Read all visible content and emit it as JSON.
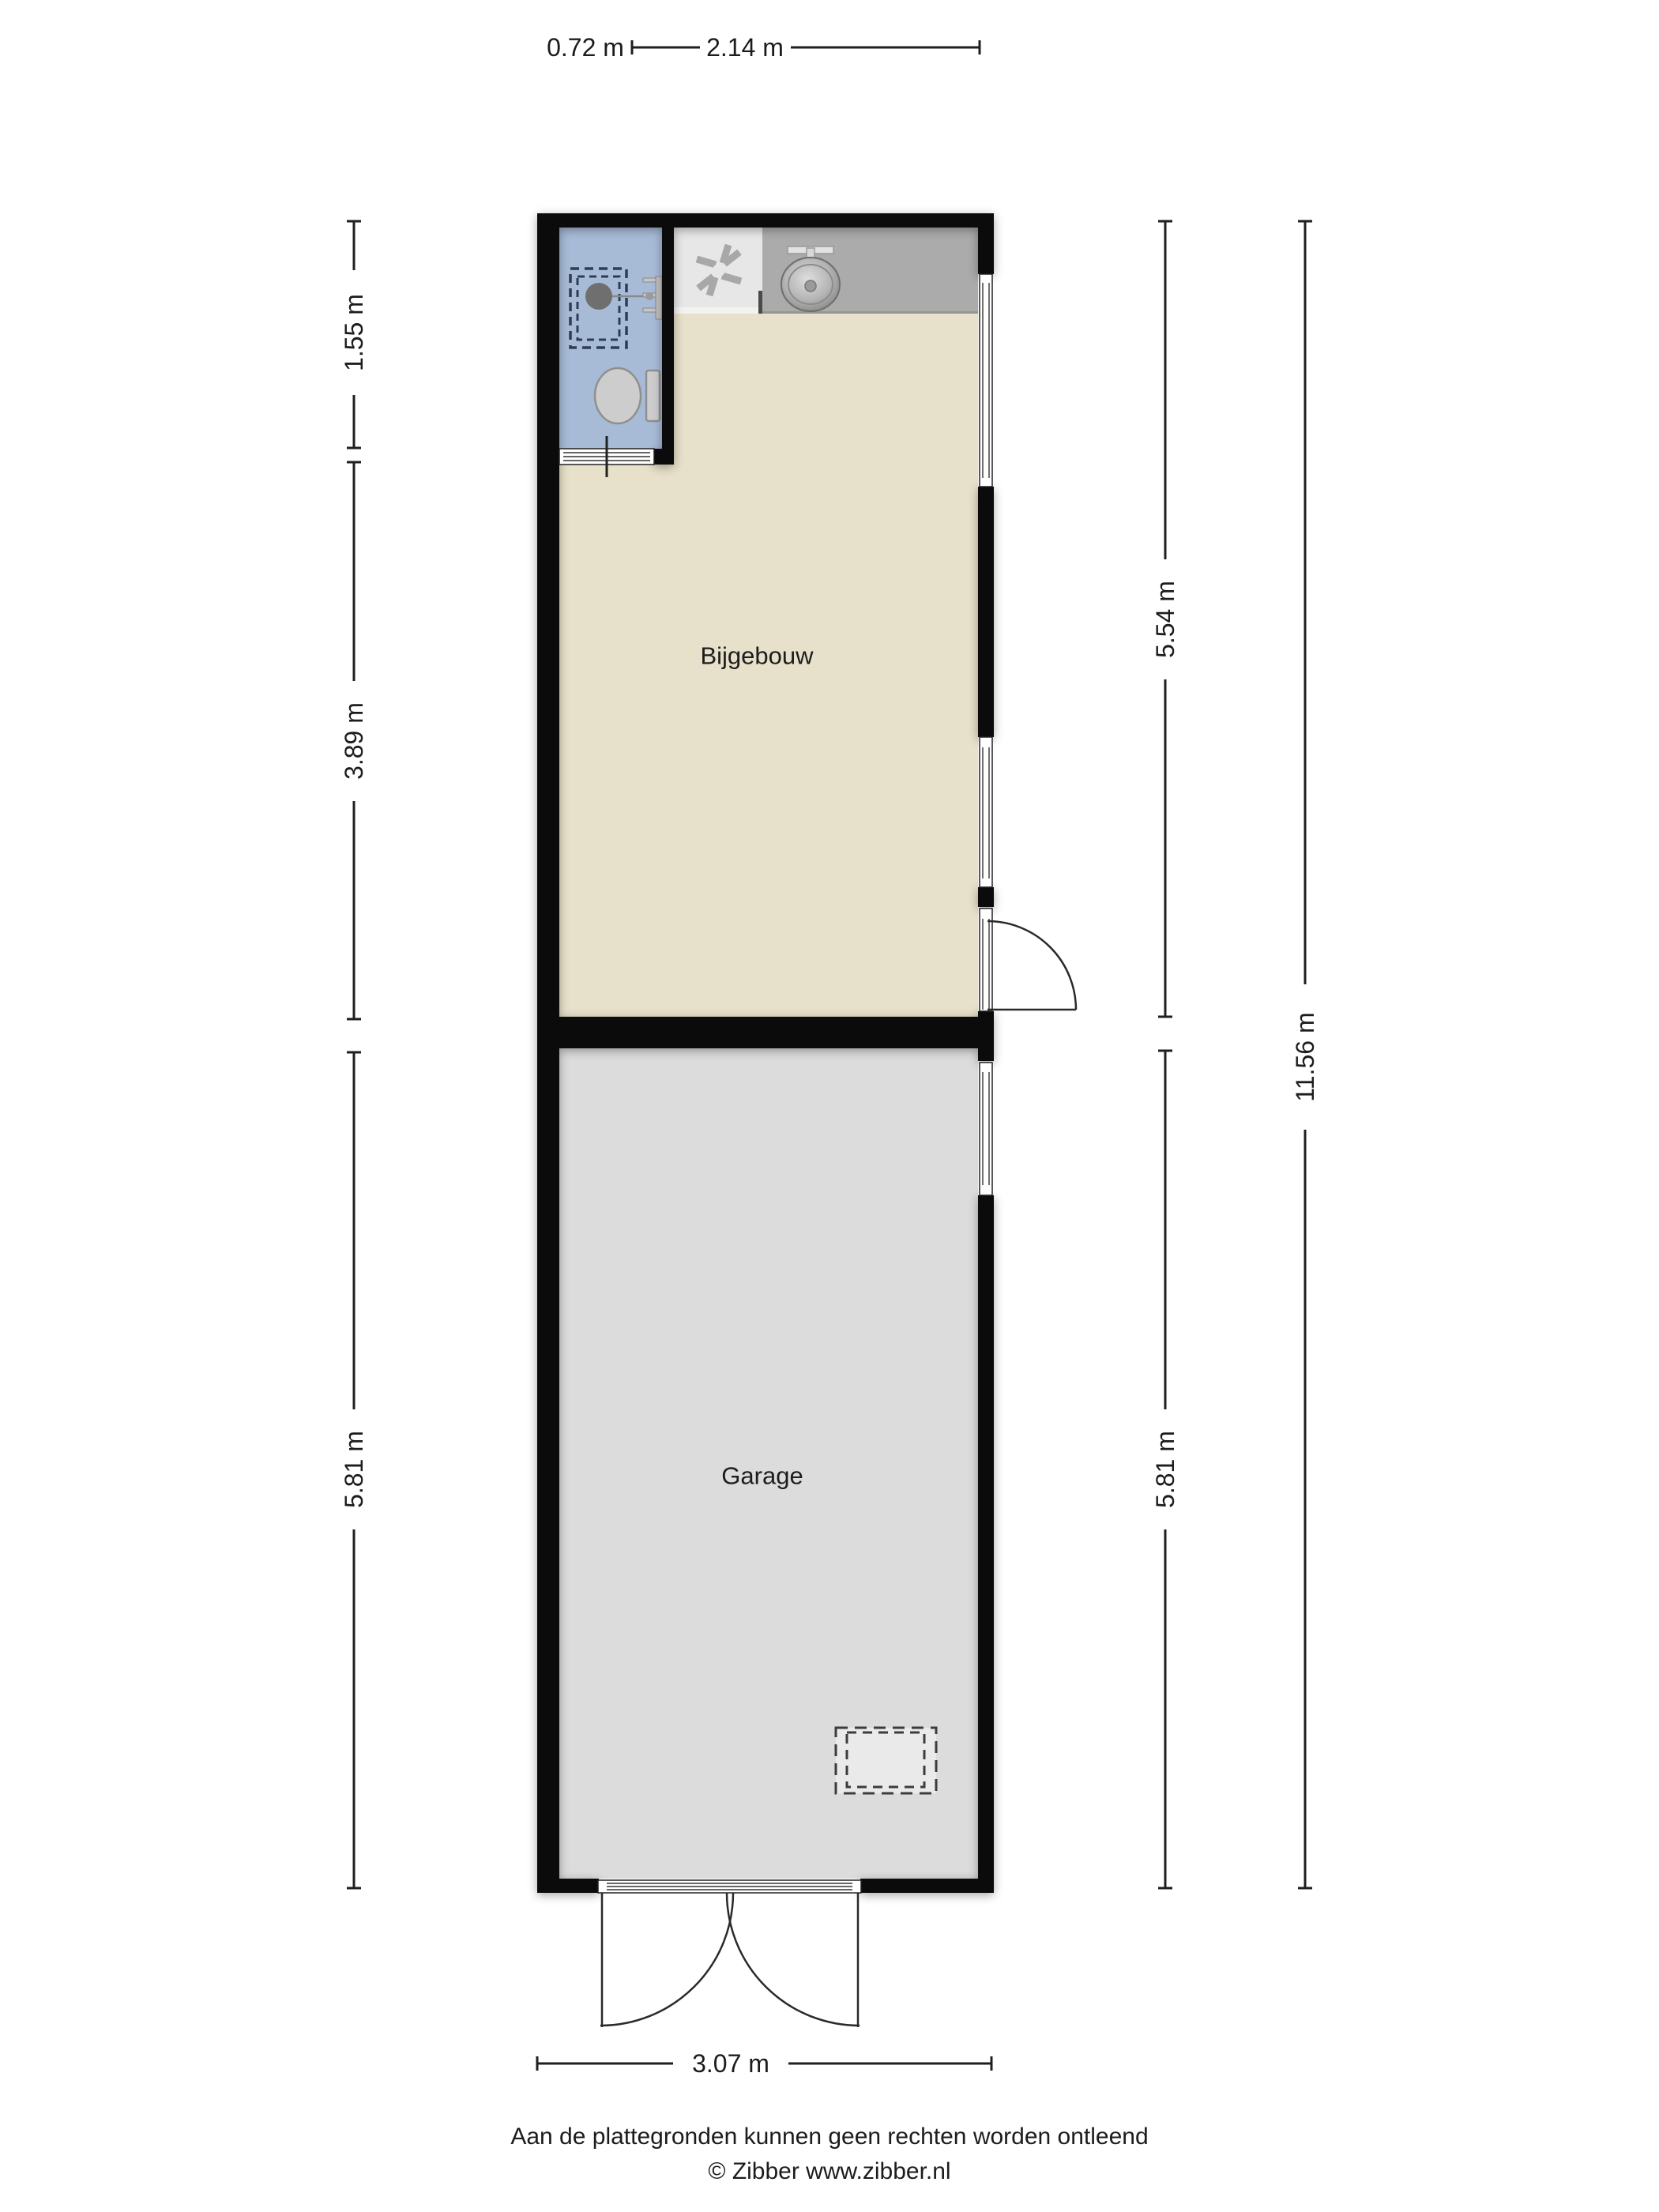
{
  "floorplan": {
    "rooms": [
      {
        "label": "Bijgebouw"
      },
      {
        "label": "Garage"
      }
    ],
    "dimensions": {
      "top_left": "0.72 m",
      "top": "2.14 m",
      "left": [
        "1.55 m",
        "3.89 m",
        "5.81 m"
      ],
      "right": [
        "5.54 m",
        "5.81 m"
      ],
      "right_total": "11.56 m",
      "bottom": "3.07 m"
    },
    "fixtures": [
      "shower",
      "shower-drain",
      "toilet",
      "extractor-fan",
      "kitchen-sink",
      "garage-hatch"
    ],
    "colors": {
      "wall": "#0b0b0b",
      "bijgebouw_floor": "#e7e0ca",
      "garage_floor": "#dcdcdc",
      "bathroom_floor": "#a7bbd7",
      "cabinet": "#e7e7e7",
      "counter": "#ababab",
      "dimension_line": "#1f1f1f"
    }
  },
  "footer": {
    "disclaimer": "Aan de plattegronden kunnen geen rechten worden ontleend",
    "copyright": "© Zibber www.zibber.nl"
  }
}
